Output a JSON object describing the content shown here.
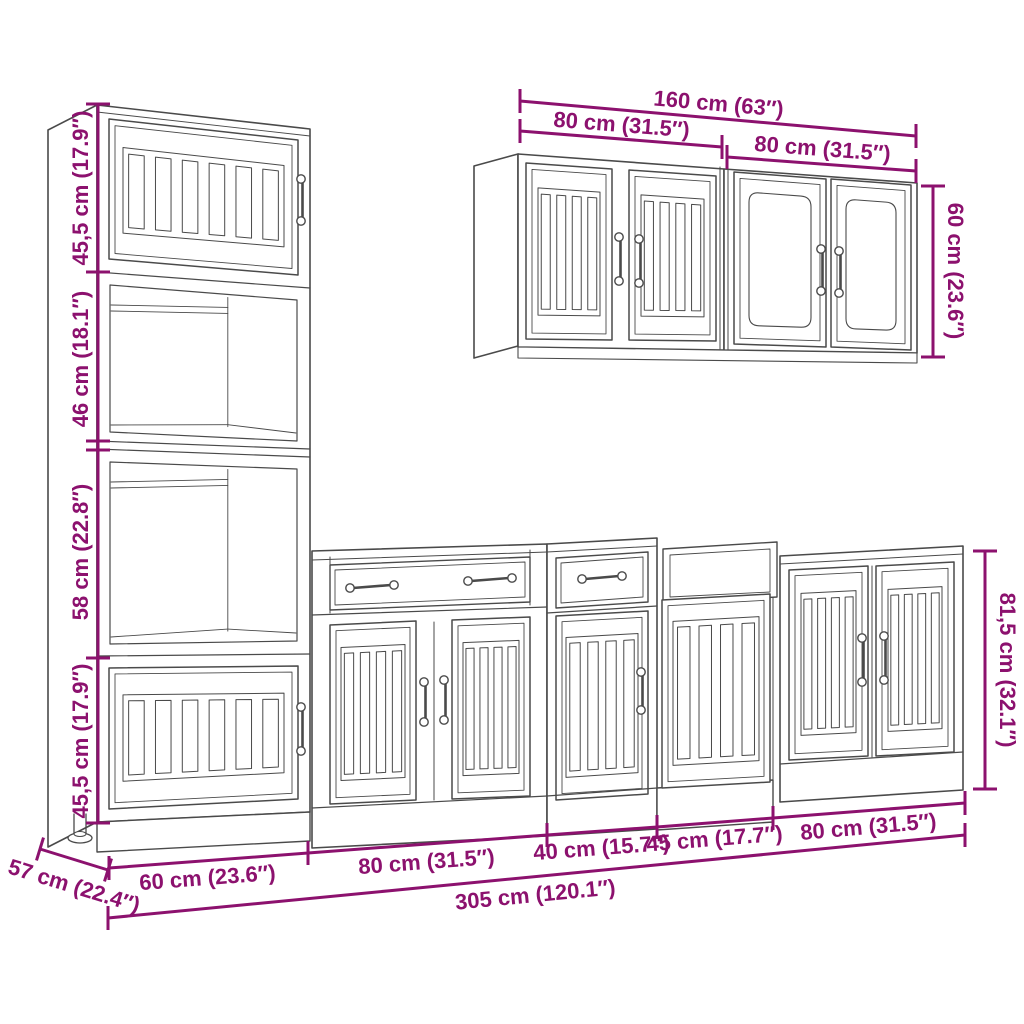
{
  "colors": {
    "dimension_lines": "#8C116E",
    "line_art": "#4a4a4a",
    "background": "#ffffff"
  },
  "labels": {
    "wall_total": "160 cm (63″)",
    "wall_left": "80 cm (31.5″)",
    "wall_right": "80 cm (31.5″)",
    "wall_height": "60 cm (23.6″)",
    "tall_s1": "45,5 cm (17.9″)",
    "tall_s2": "46 cm (18.1″)",
    "tall_s3": "58 cm (22.8″)",
    "tall_s4": "45,5 cm (17.9″)",
    "depth": "57 cm (22.4″)",
    "base_60": "60 cm (23.6″)",
    "base_80l": "80 cm (31.5″)",
    "base_40": "40 cm (15.7″)",
    "base_45": "45 cm (17.7″)",
    "base_80r": "80 cm (31.5″)",
    "base_height": "81,5 cm (32.1″)",
    "total": "305 cm (120.1″)"
  }
}
